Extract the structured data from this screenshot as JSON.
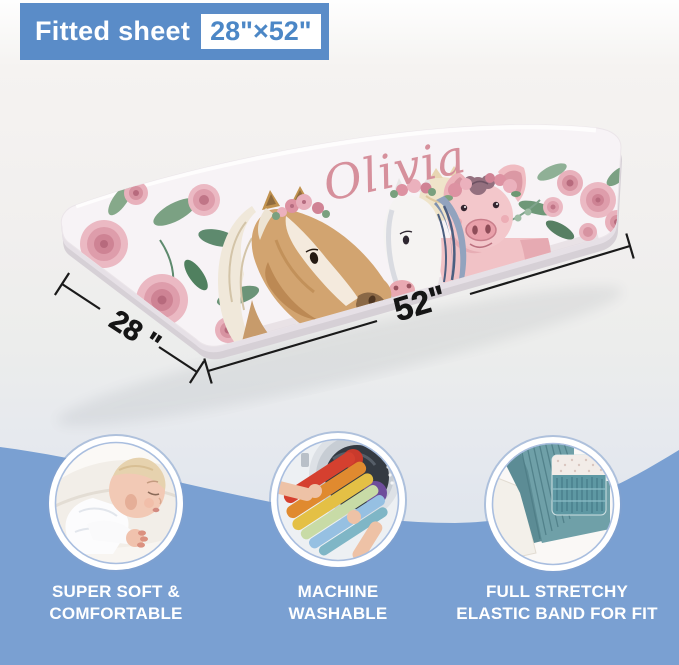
{
  "header": {
    "product_type": "Fitted sheet",
    "size": "28\"×52\""
  },
  "sheet": {
    "personalized_name": "Olivia",
    "width_label": "28 \"",
    "length_label": "52\""
  },
  "features": [
    {
      "icon": "sleeping-baby-photo",
      "lines": [
        "SUPER SOFT &",
        "COMFORTABLE"
      ]
    },
    {
      "icon": "washing-machine-laundry-photo",
      "lines": [
        "MACHINE",
        "WASHABLE"
      ]
    },
    {
      "icon": "elastic-band-corner-photo",
      "lines": [
        "FULL STRETCHY",
        "ELASTIC BAND FOR FIT"
      ]
    }
  ],
  "colors": {
    "header_blue": "#5a8cc8",
    "footer_blue": "#7aa0d2",
    "name_pink": "#d6909c"
  }
}
